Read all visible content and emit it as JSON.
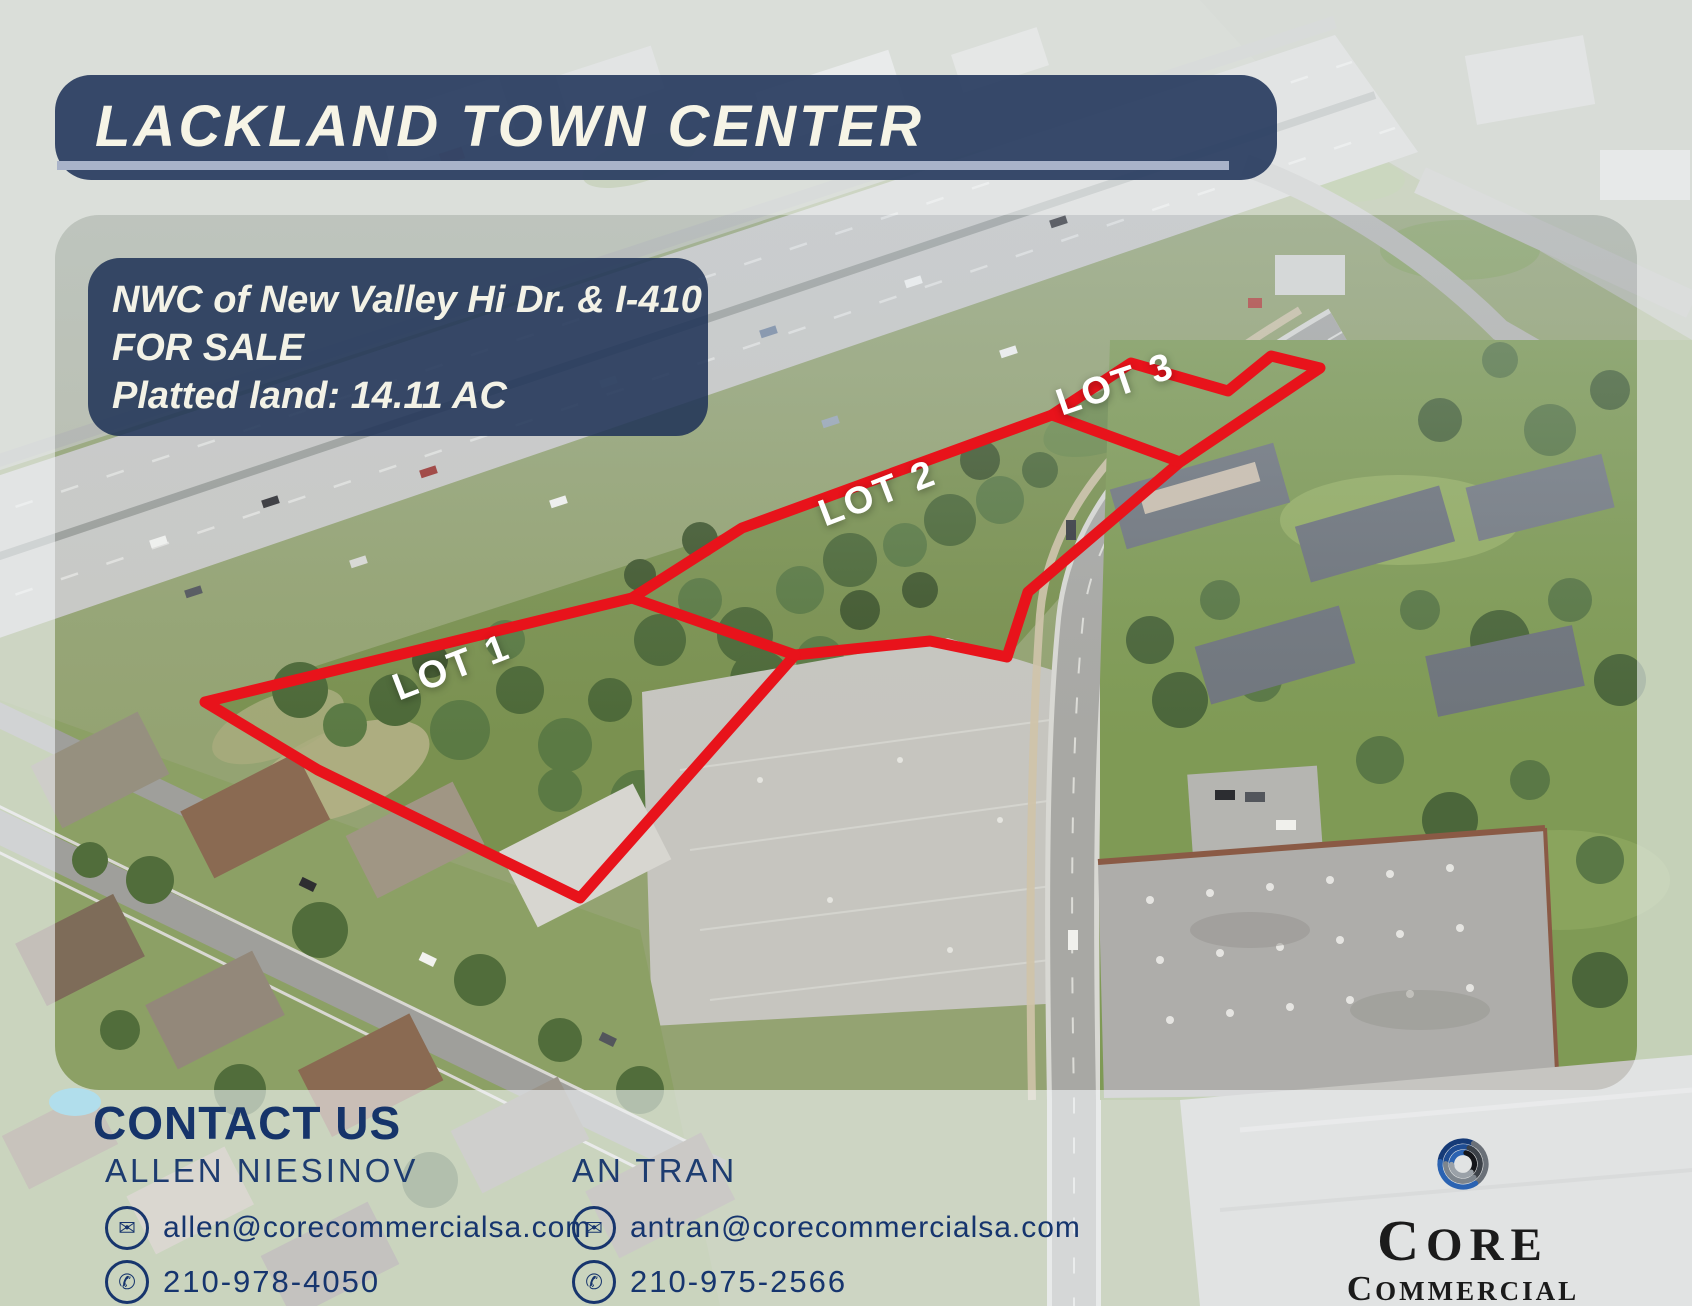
{
  "title_banner": {
    "title": "LACKLAND TOWN CENTER"
  },
  "info_box": {
    "line1": "NWC of New Valley Hi Dr. & I-410",
    "line2": "FOR SALE",
    "line3": "Platted land: 14.11 AC"
  },
  "map": {
    "lots": [
      {
        "label": "LOT 1",
        "x": 452,
        "y": 668,
        "rotation": -21
      },
      {
        "label": "LOT 2",
        "x": 878,
        "y": 494,
        "rotation": -21
      },
      {
        "label": "LOT 3",
        "x": 1116,
        "y": 385,
        "rotation": -19
      }
    ],
    "outer_boundary": "205,702 632,598 742,528 1052,415 1131,363 1228,391 1271,356 1320,368 1180,462 1028,592 1007,657 930,641 795,655 580,898 318,770 205,702",
    "divider_lot1_lot2": "632,598 795,655",
    "divider_lot2_lot3": "1052,415 1180,462"
  },
  "contact": {
    "heading": "CONTACT US",
    "agents": [
      {
        "name": "ALLEN NIESINOV",
        "email": "allen@corecommercialsa.com",
        "phone": "210-978-4050"
      },
      {
        "name": "AN TRAN",
        "email": "antran@corecommercialsa.com",
        "phone": "210-975-2566"
      }
    ]
  },
  "logo": {
    "line1": "CORE",
    "line2": "COMMERCIAL"
  },
  "icons": {
    "email": "✉",
    "phone": "✆"
  },
  "colors": {
    "accent_red": "#e8131b",
    "banner_navy": "#2c3f62",
    "navy_text": "#16346a",
    "stripe": "#a9b3c9",
    "cream": "#f6f4e6"
  }
}
